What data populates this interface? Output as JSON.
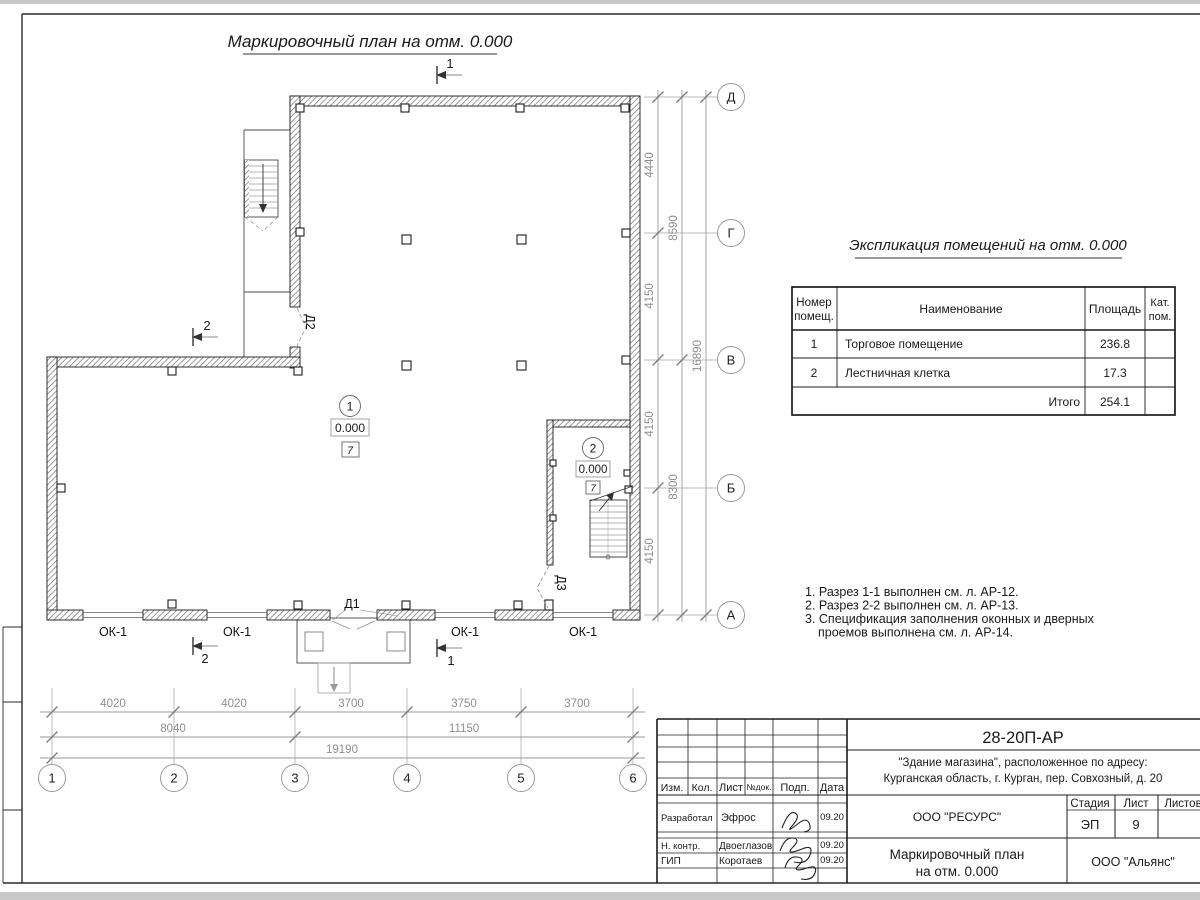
{
  "page": {
    "title": "Маркировочный план на отм. 0.000"
  },
  "plan": {
    "axes_h": [
      "1",
      "2",
      "3",
      "4",
      "5",
      "6"
    ],
    "axes_v": [
      "Д",
      "Г",
      "В",
      "Б",
      "А"
    ],
    "dims": {
      "bottom1": [
        "4020",
        "4020",
        "3700",
        "3750",
        "3700"
      ],
      "bottom2": [
        "8040",
        "11150"
      ],
      "bottom3": "19190",
      "right1": [
        "4440",
        "4150",
        "4150",
        "4150"
      ],
      "right2": [
        "8590",
        "8300"
      ],
      "right3": "16890"
    },
    "rooms": [
      {
        "num": "1",
        "elev": "0.000",
        "floor": "7"
      },
      {
        "num": "2",
        "elev": "0.000",
        "floor": "7"
      }
    ],
    "doors": {
      "d1": "Д1",
      "d2": "Д2",
      "d3": "Д3"
    },
    "window_mark": "ОК-1",
    "sections": {
      "s1": "1",
      "s2": "2"
    }
  },
  "explication": {
    "title": "Экспликация помещений на отм. 0.000",
    "col_num_line1": "Номер",
    "col_num_line2": "помещ.",
    "col_name": "Наименование",
    "col_area": "Площадь",
    "col_cat_line1": "Кат.",
    "col_cat_line2": "пом.",
    "rows": [
      {
        "num": "1",
        "name": "Торговое помещение",
        "area": "236.8"
      },
      {
        "num": "2",
        "name": "Лестничная клетка",
        "area": "17.3"
      }
    ],
    "total_label": "Итого",
    "total_area": "254.1"
  },
  "notes": {
    "line1": "1. Разрез 1-1 выполнен см. л. АР-12.",
    "line2": "2. Разрез 2-2 выполнен см. л. АР-13.",
    "line3": "3. Спецификация заполнения оконных и дверных",
    "line4": "проемов выполнена см. л. АР-14."
  },
  "titleblock": {
    "doc_number": "28-20П-АР",
    "project_line1": "\"Здание магазина\", расположенное по адресу:",
    "project_line2": "Курганская область, г. Курган, пер. Совхозный, д. 20",
    "org_designer": "ООО \"РЕСУРС\"",
    "org_client": "ООО \"Альянс\"",
    "sheet_name_line1": "Маркировочный план",
    "sheet_name_line2": "на отм. 0.000",
    "stage_label": "Стадия",
    "sheet_label": "Лист",
    "sheets_label": "Листов",
    "stage_value": "ЭП",
    "sheet_value": "9",
    "cols": {
      "izm": "Изм.",
      "kol": "Кол.",
      "list": "Лист",
      "doc": "№док.",
      "podp": "Подп.",
      "data": "Дата"
    },
    "rows": [
      {
        "role": "Разработал",
        "name": "Эфрос",
        "date": "09.20"
      },
      {
        "role": "Н. контр.",
        "name": "Двоеглазов",
        "date": "09.20"
      },
      {
        "role": "ГИП",
        "name": "Коротаев",
        "date": "09.20"
      }
    ]
  }
}
